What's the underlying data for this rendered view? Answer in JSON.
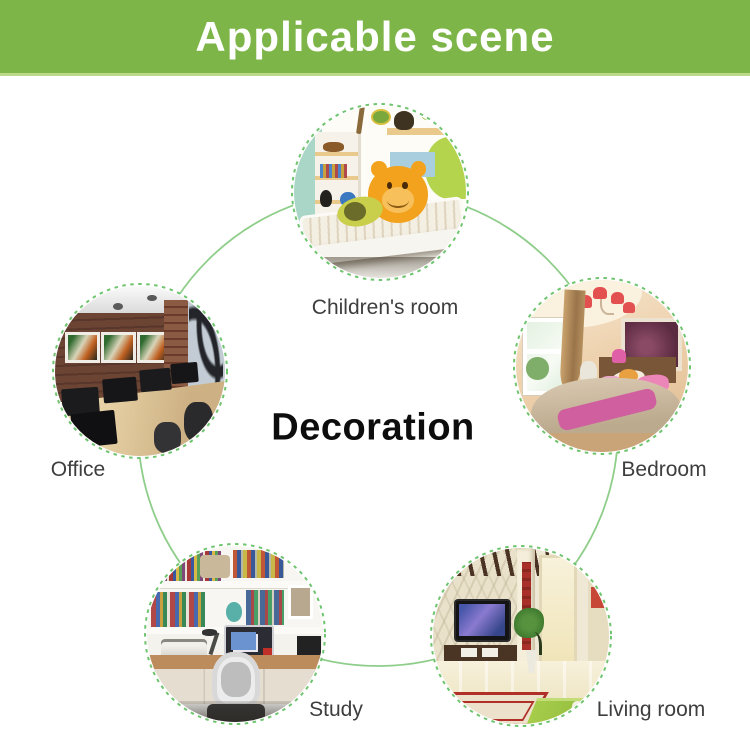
{
  "header": {
    "title": "Applicable scene"
  },
  "center": {
    "title": "Decoration"
  },
  "diagram": {
    "scenes": [
      {
        "id": "children-room",
        "label": "Children's room"
      },
      {
        "id": "bedroom",
        "label": "Bedroom"
      },
      {
        "id": "office",
        "label": "Office"
      },
      {
        "id": "study",
        "label": "Study"
      },
      {
        "id": "living-room",
        "label": "Living room"
      }
    ]
  },
  "theme": {
    "banner_bg": "#7db548",
    "banner_edge": "#bcd98a",
    "banner_text": "#ffffff",
    "connector": "#8fce8a",
    "ring": "#6fc46f",
    "label": "#3e3e3e",
    "title": "#0d0d0d"
  }
}
